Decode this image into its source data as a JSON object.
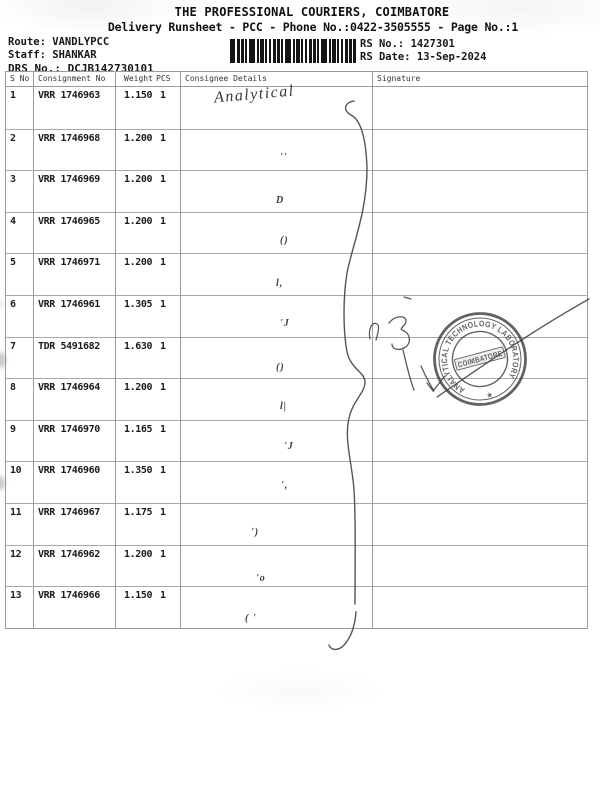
{
  "document": {
    "title": "THE PROFESSIONAL COURIERS, COIMBATORE",
    "subtitle": "Delivery Runsheet - PCC - Phone No.:0422-3505555 - Page No.:1",
    "info_left": {
      "route_label": "Route:",
      "route_value": "VANDLYPCC",
      "staff_label": "Staff:",
      "staff_value": "SHANKAR",
      "drs_label": "DRS No.:",
      "drs_value": "DCJB142730101"
    },
    "info_right": {
      "rs_no_label": "RS No.:",
      "rs_no_value": "1427301",
      "rs_date_label": "RS Date:",
      "rs_date_value": "13-Sep-2024"
    }
  },
  "table": {
    "columns": {
      "sno": "S No",
      "consignment": "Consignment No",
      "weight": "Weight",
      "pcs": "PCS",
      "consignee": "Consignee Details",
      "signature": "Signature"
    },
    "rows": [
      {
        "sno": "1",
        "consignment": "VRR 1746963",
        "weight": "1.150",
        "pcs": "1",
        "ditto": ""
      },
      {
        "sno": "2",
        "consignment": "VRR 1746968",
        "weight": "1.200",
        "pcs": "1",
        "ditto": "''"
      },
      {
        "sno": "3",
        "consignment": "VRR 1746969",
        "weight": "1.200",
        "pcs": "1",
        "ditto": "D"
      },
      {
        "sno": "4",
        "consignment": "VRR 1746965",
        "weight": "1.200",
        "pcs": "1",
        "ditto": "()"
      },
      {
        "sno": "5",
        "consignment": "VRR 1746971",
        "weight": "1.200",
        "pcs": "1",
        "ditto": "l,"
      },
      {
        "sno": "6",
        "consignment": "VRR 1746961",
        "weight": "1.305",
        "pcs": "1",
        "ditto": "'J"
      },
      {
        "sno": "7",
        "consignment": "TDR 5491682",
        "weight": "1.630",
        "pcs": "1",
        "ditto": "()"
      },
      {
        "sno": "8",
        "consignment": "VRR 1746964",
        "weight": "1.200",
        "pcs": "1",
        "ditto": "l|"
      },
      {
        "sno": "9",
        "consignment": "VRR 1746970",
        "weight": "1.165",
        "pcs": "1",
        "ditto": "'J"
      },
      {
        "sno": "10",
        "consignment": "VRR 1746960",
        "weight": "1.350",
        "pcs": "1",
        "ditto": "',"
      },
      {
        "sno": "11",
        "consignment": "VRR 1746967",
        "weight": "1.175",
        "pcs": "1",
        "ditto": "')"
      },
      {
        "sno": "12",
        "consignment": "VRR 1746962",
        "weight": "1.200",
        "pcs": "1",
        "ditto": "'o"
      },
      {
        "sno": "13",
        "consignment": "VRR 1746966",
        "weight": "1.150",
        "pcs": "1",
        "ditto": "( '"
      }
    ]
  },
  "handwriting": {
    "consignee_note": "Analytical",
    "ink_color": "#3d3d3d"
  },
  "stamp": {
    "ring_text": "ANALYTICAL TECHNOLOGY LABORATORY",
    "center_text": "COIMBATORE",
    "star": "★",
    "color": "#414141"
  }
}
